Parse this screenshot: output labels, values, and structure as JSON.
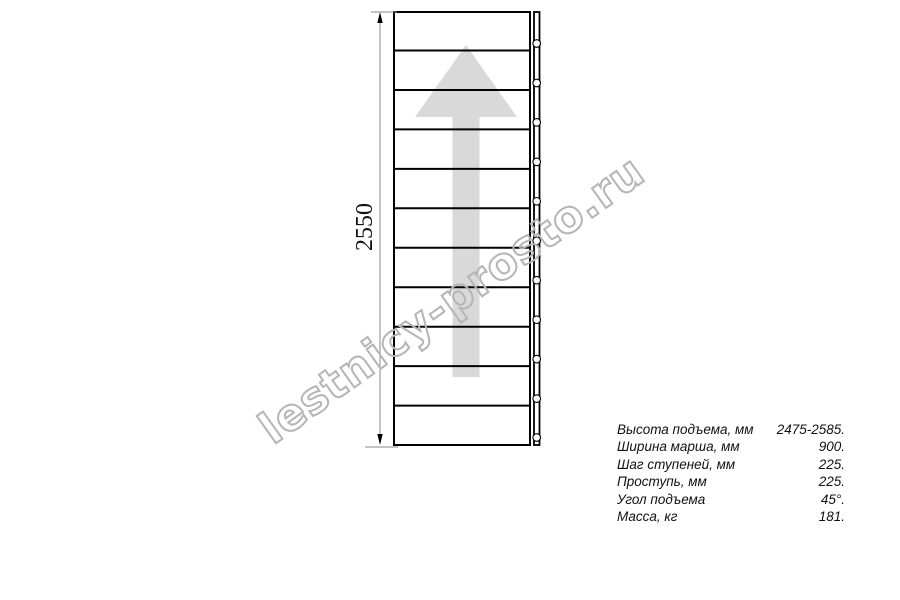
{
  "watermark": {
    "text": "lestnicy-prosto.ru"
  },
  "diagram": {
    "type": "staircase-plan-top-view",
    "dimension_label": "2550",
    "steps_count": 11,
    "colors": {
      "line": "#000000",
      "arrow_fill": "#d9d9d9",
      "dimension_line": "#8a8a8a",
      "watermark_outline": "#b5b5b5"
    }
  },
  "specs": {
    "rows": [
      {
        "label": "Высота подъема, мм",
        "value": "2475-2585."
      },
      {
        "label": "Ширина марша, мм",
        "value": "900."
      },
      {
        "label": "Шаг ступеней, мм",
        "value": "225."
      },
      {
        "label": "Проступь, мм",
        "value": "225."
      },
      {
        "label": "Угол подъема",
        "value": "45°."
      },
      {
        "label": "Масса, кг",
        "value": "181."
      }
    ]
  }
}
